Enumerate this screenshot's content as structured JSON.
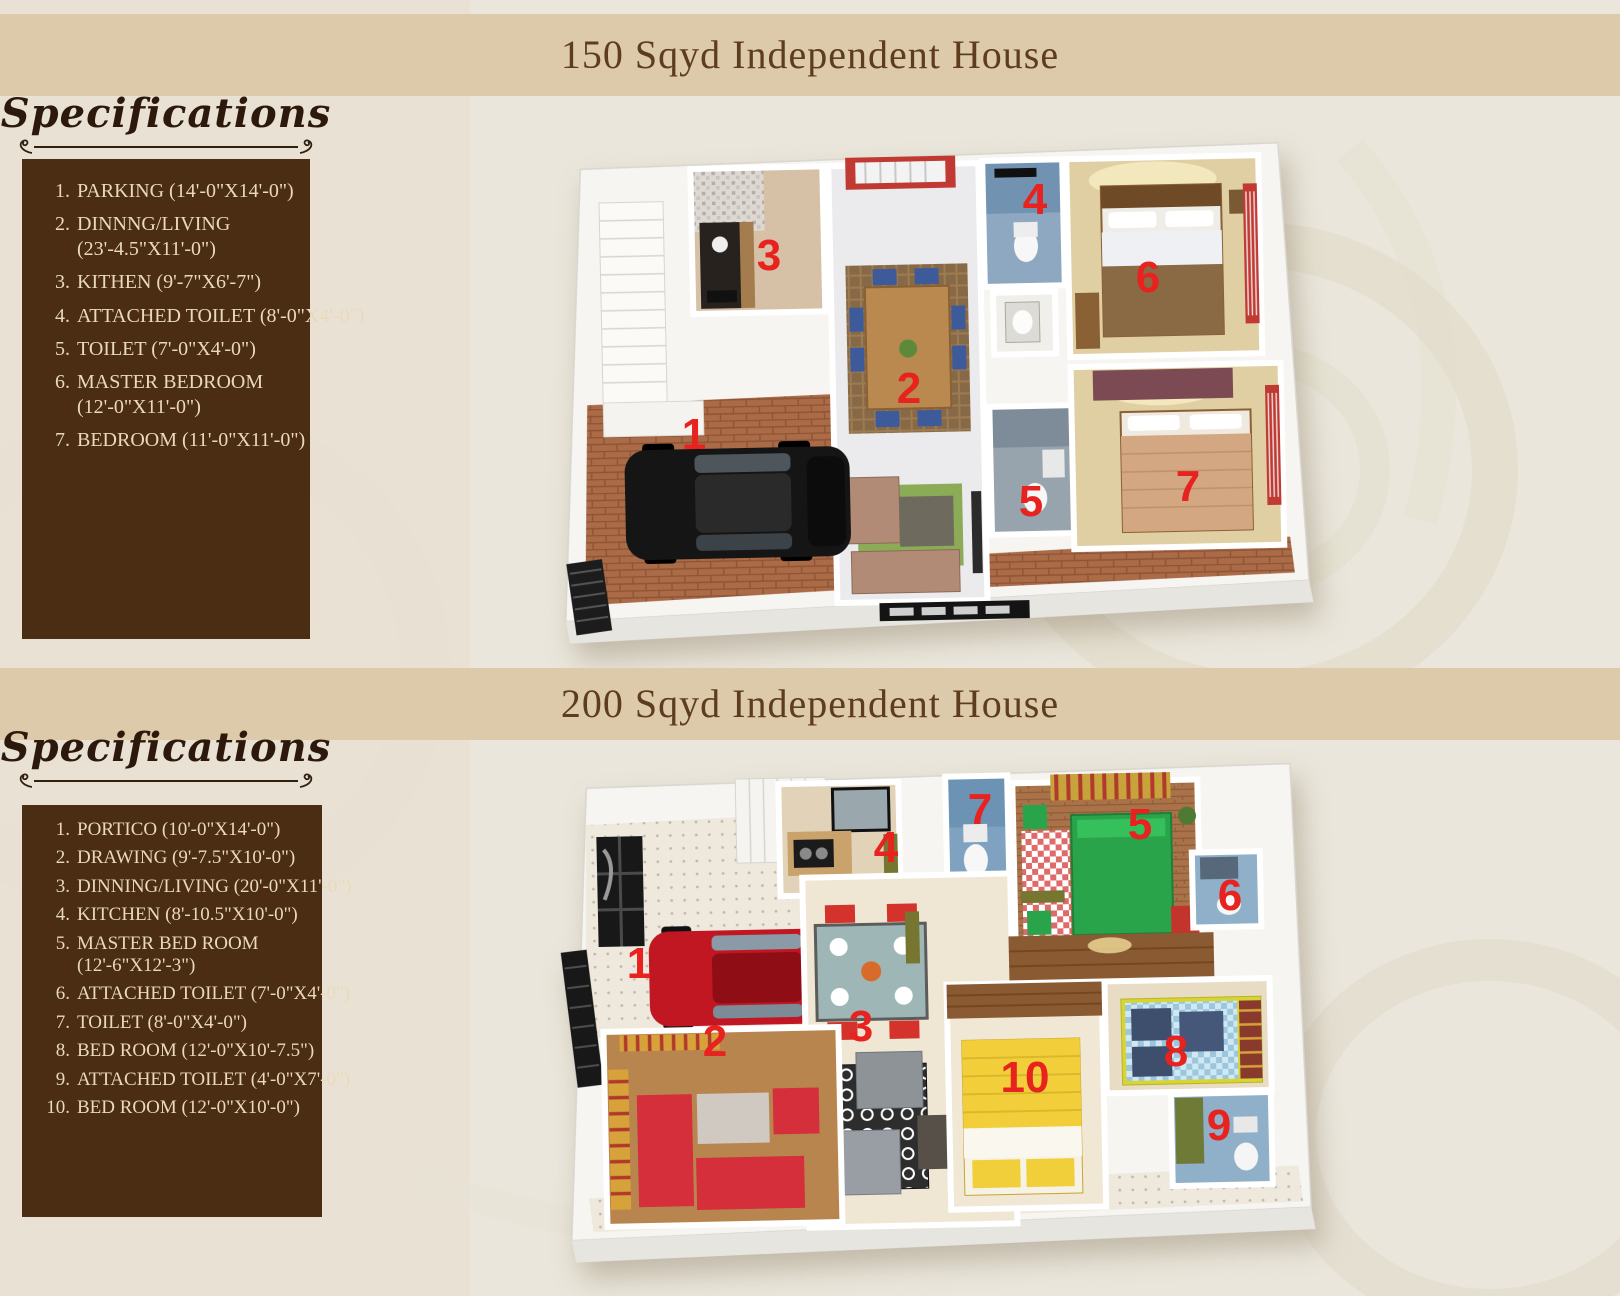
{
  "colors": {
    "page_background": "#eae6db",
    "title_band": "#dccaaa",
    "title_text": "#5e3d1e",
    "spec_box": "#4a2d13",
    "spec_text": "#ead9ba",
    "heading_script": "#2c190c",
    "room_number_red": "#e8221e"
  },
  "sections": [
    {
      "title": "150 Sqyd Independent House",
      "specs_heading": "Specifications",
      "specs": [
        {
          "num": "1.",
          "lines": [
            "PARKING (14'-0\"X14'-0\")"
          ]
        },
        {
          "num": "2.",
          "lines": [
            "DINNNG/LIVING",
            "(23'-4.5\"X11'-0\")"
          ]
        },
        {
          "num": "3.",
          "lines": [
            "KITHEN (9'-7\"X6'-7\")"
          ]
        },
        {
          "num": "4.",
          "lines": [
            "ATTACHED TOILET (8'-0\"X4'-0\")"
          ]
        },
        {
          "num": "5.",
          "lines": [
            "TOILET (7'-0\"X4'-0\")"
          ]
        },
        {
          "num": "6.",
          "lines": [
            "MASTER BEDROOM",
            "(12'-0\"X11'-0\")"
          ]
        },
        {
          "num": "7.",
          "lines": [
            "BEDROOM  (11'-0\"X11'-0\")"
          ]
        }
      ],
      "plan_labels": [
        {
          "n": "1",
          "x": 149,
          "y": 299
        },
        {
          "n": "2",
          "x": 364,
          "y": 253
        },
        {
          "n": "3",
          "x": 224,
          "y": 120
        },
        {
          "n": "4",
          "x": 490,
          "y": 64
        },
        {
          "n": "5",
          "x": 486,
          "y": 366
        },
        {
          "n": "6",
          "x": 603,
          "y": 142
        },
        {
          "n": "7",
          "x": 643,
          "y": 351
        }
      ]
    },
    {
      "title": "200 Sqyd Independent House",
      "specs_heading": "Specifications",
      "specs": [
        {
          "num": "1.",
          "lines": [
            "PORTICO (10'-0\"X14'-0\")"
          ]
        },
        {
          "num": "2.",
          "lines": [
            "DRAWING (9'-7.5\"X10'-0\")"
          ]
        },
        {
          "num": "3.",
          "lines": [
            "DINNING/LIVING (20'-0\"X11'-0\")"
          ]
        },
        {
          "num": "4.",
          "lines": [
            "KITCHEN (8'-10.5\"X10'-0\")"
          ]
        },
        {
          "num": "5.",
          "lines": [
            "MASTER BED ROOM",
            "(12'-6\"X12'-3\")"
          ]
        },
        {
          "num": "6.",
          "lines": [
            "ATTACHED TOILET (7'-0\"X4'-0\")"
          ]
        },
        {
          "num": "7.",
          "lines": [
            "TOILET (8'-0\"X4'-0\")"
          ]
        },
        {
          "num": "8.",
          "lines": [
            "BED ROOM (12'-0\"X10'-7.5\")"
          ]
        },
        {
          "num": "9.",
          "lines": [
            "ATTACHED TOILET (4'-0\"X7'-0\")"
          ]
        },
        {
          "num": "10.",
          "lines": [
            "BED ROOM (12'-0\"X10'-0\")"
          ]
        }
      ],
      "plan_labels": [
        {
          "n": "1",
          "x": 84,
          "y": 201
        },
        {
          "n": "2",
          "x": 160,
          "y": 279
        },
        {
          "n": "3",
          "x": 306,
          "y": 264
        },
        {
          "n": "4",
          "x": 331,
          "y": 85
        },
        {
          "n": "5",
          "x": 585,
          "y": 62
        },
        {
          "n": "6",
          "x": 675,
          "y": 133
        },
        {
          "n": "7",
          "x": 425,
          "y": 47
        },
        {
          "n": "8",
          "x": 621,
          "y": 289
        },
        {
          "n": "9",
          "x": 664,
          "y": 363
        },
        {
          "n": "10",
          "x": 470,
          "y": 315
        }
      ]
    }
  ]
}
